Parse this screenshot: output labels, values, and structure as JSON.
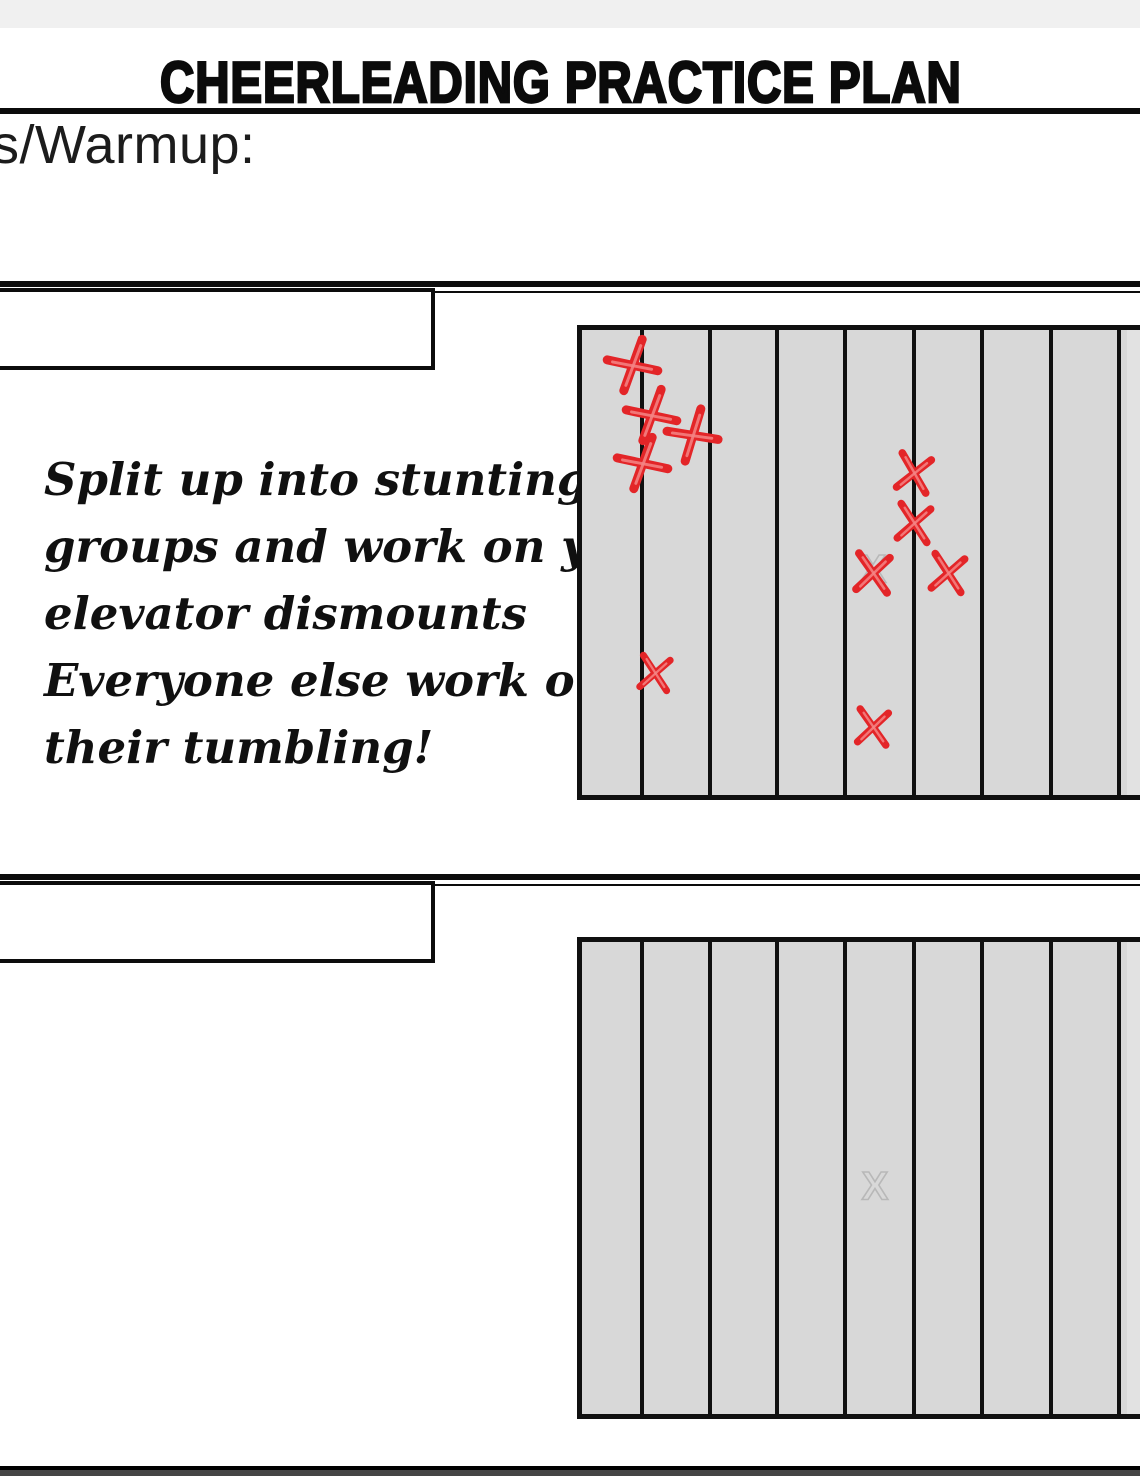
{
  "header": {
    "title": "CHEERLEADING PRACTICE PLAN",
    "field_label": "s/Warmup:"
  },
  "note": {
    "lines": [
      "Split up into stunting",
      "groups and work on your",
      "elevator dismounts",
      "Everyone else work on",
      "their tumbling!"
    ]
  },
  "colors": {
    "mat_background": "#d8d8d8",
    "mat_line": "#101010",
    "mark_red": "#e32528",
    "mark_red_light": "#f58585",
    "watermark_grey": "#b8b8b8",
    "divider_black": "#0c0c0c"
  },
  "mats": [
    {
      "name": "stunting-mat",
      "box": {
        "left": 577,
        "top": 325,
        "width": 563,
        "height": 475
      },
      "line_offsets": [
        65,
        133,
        200,
        268,
        337,
        405,
        474,
        542
      ],
      "watermark": {
        "glyph": "X",
        "x": 296,
        "y": 245
      },
      "marks": [
        {
          "x": 56,
          "y": 40,
          "s": 54,
          "rot": 58
        },
        {
          "x": 75,
          "y": 90,
          "s": 54,
          "rot": 58
        },
        {
          "x": 116,
          "y": 110,
          "s": 54,
          "rot": 55
        },
        {
          "x": 66,
          "y": 138,
          "s": 54,
          "rot": 58
        },
        {
          "x": 337,
          "y": 148,
          "s": 46,
          "rot": 8
        },
        {
          "x": 337,
          "y": 198,
          "s": 46,
          "rot": 5
        },
        {
          "x": 296,
          "y": 248,
          "s": 48,
          "rot": 3
        },
        {
          "x": 371,
          "y": 248,
          "s": 46,
          "rot": 5
        },
        {
          "x": 78,
          "y": 348,
          "s": 42,
          "rot": 5
        },
        {
          "x": 296,
          "y": 402,
          "s": 44,
          "rot": 3
        }
      ]
    },
    {
      "name": "empty-mat",
      "box": {
        "left": 577,
        "top": 937,
        "width": 563,
        "height": 482
      },
      "line_offsets": [
        65,
        133,
        200,
        268,
        337,
        405,
        474,
        542
      ],
      "watermark": {
        "glyph": "X",
        "x": 298,
        "y": 250
      },
      "marks": []
    }
  ]
}
